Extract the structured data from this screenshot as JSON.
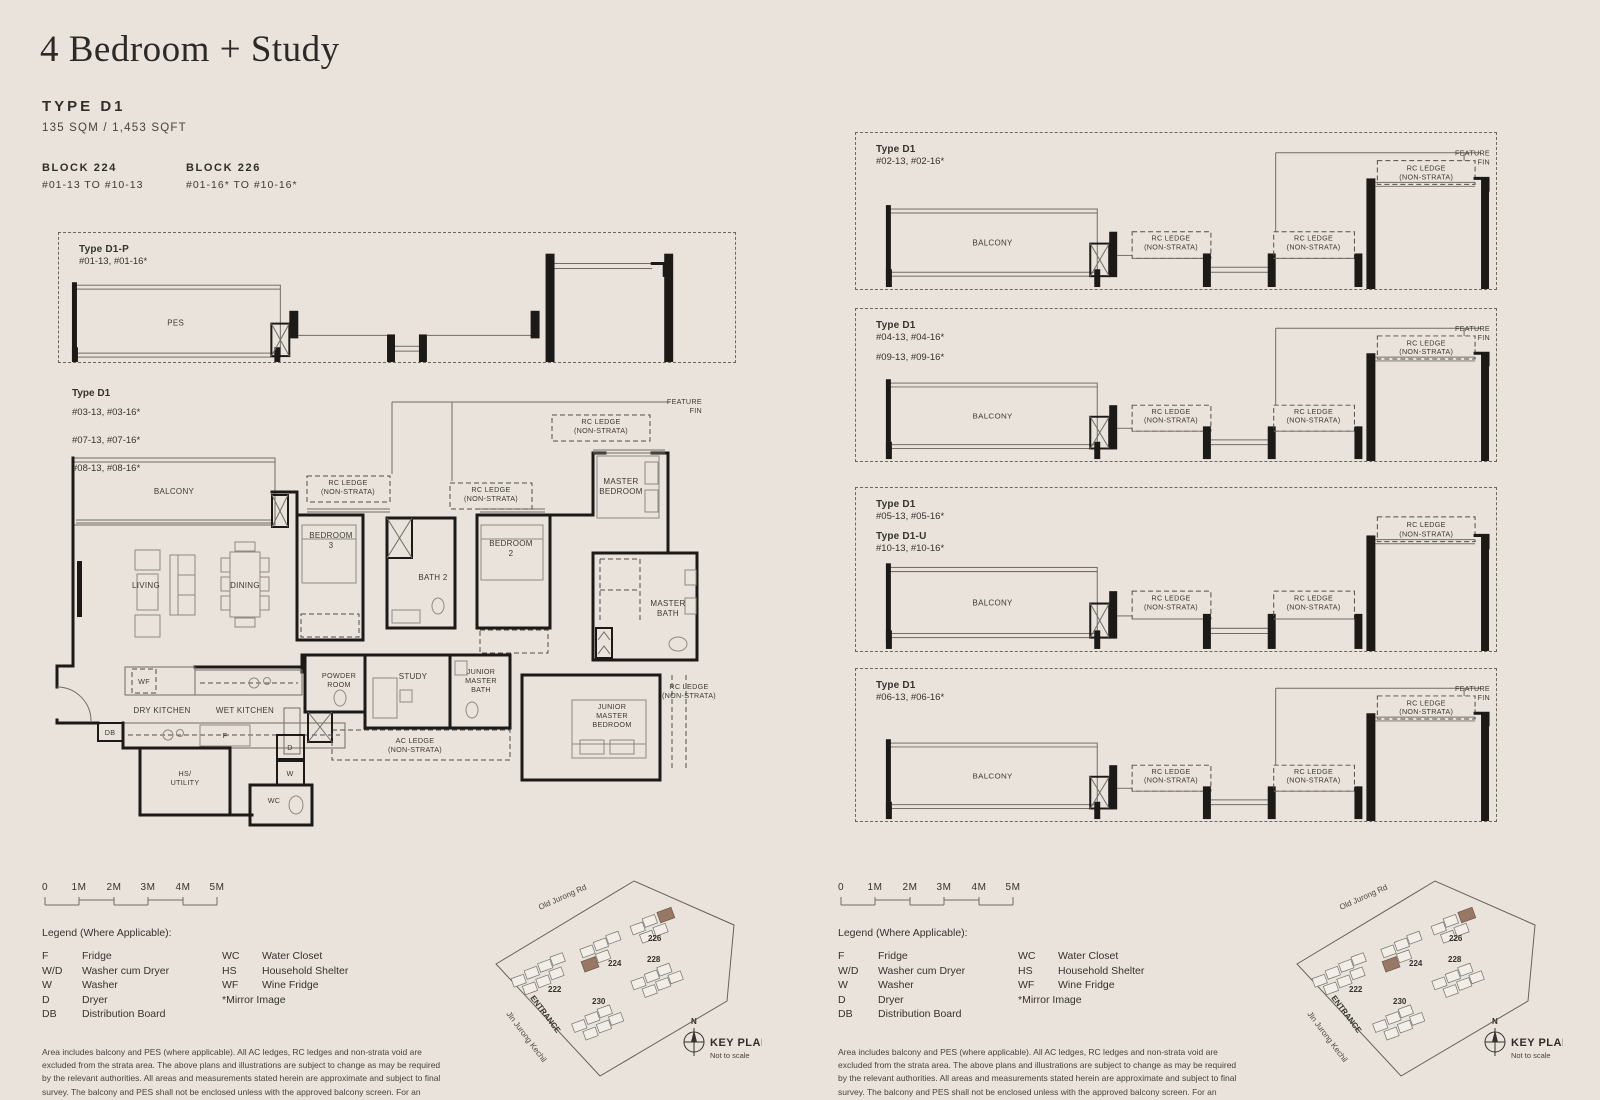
{
  "header": {
    "title": "4 Bedroom + Study",
    "type_label": "TYPE D1",
    "area": "135 SQM / 1,453 SQFT",
    "blocks": [
      {
        "name": "BLOCK 224",
        "units": "#01-13 TO #10-13"
      },
      {
        "name": "BLOCK 226",
        "units": "#01-16* TO #10-16*"
      }
    ]
  },
  "d1p": {
    "type": "Type D1-P",
    "units": "#01-13, #01-16*",
    "pes": "PES"
  },
  "main_plan": {
    "type": "Type D1",
    "units": [
      "#03-13, #03-16*",
      "#07-13, #07-16*",
      "#08-13, #08-16*"
    ],
    "rooms": {
      "balcony": "BALCONY",
      "living": "LIVING",
      "dining": "DINING",
      "bedroom3": [
        "BEDROOM",
        "3"
      ],
      "bath2": "BATH 2",
      "bedroom2": [
        "BEDROOM",
        "2"
      ],
      "master_bedroom": [
        "MASTER",
        "BEDROOM"
      ],
      "master_bath": [
        "MASTER",
        "BATH"
      ],
      "dry_kitchen": "DRY KITCHEN",
      "wet_kitchen": "WET KITCHEN",
      "powder_room": [
        "POWDER",
        "ROOM"
      ],
      "study": "STUDY",
      "junior_master_bath": [
        "JUNIOR",
        "MASTER",
        "BATH"
      ],
      "junior_master_bedroom": [
        "JUNIOR",
        "MASTER",
        "BEDROOM"
      ],
      "hs_utility": [
        "HS/",
        "UTILITY"
      ],
      "wc": "WC",
      "wf": "WF",
      "db": "DB",
      "f": "F",
      "d": "D",
      "w": "W"
    },
    "annotations": {
      "rc_ledge": [
        "RC LEDGE",
        "(NON-STRATA)"
      ],
      "ac_ledge": [
        "AC LEDGE",
        "(NON-STRATA)"
      ],
      "feature_fin": [
        "FEATURE",
        "FIN"
      ]
    }
  },
  "variants": [
    {
      "rows": [
        {
          "type": "Type D1",
          "units": "#02-13, #02-16*"
        }
      ]
    },
    {
      "rows": [
        {
          "type": "Type D1",
          "units": "#04-13, #04-16*"
        },
        {
          "units": "#09-13, #09-16*"
        }
      ]
    },
    {
      "rows": [
        {
          "type": "Type D1",
          "units": "#05-13, #05-16*"
        },
        {
          "type": "Type D1-U",
          "units": "#10-13, #10-16*"
        }
      ]
    },
    {
      "rows": [
        {
          "type": "Type D1",
          "units": "#06-13, #06-16*"
        }
      ]
    }
  ],
  "strip": {
    "balcony": "BALCONY",
    "rc_ledge": [
      "RC LEDGE",
      "(NON-STRATA)"
    ],
    "feature_fin": [
      "FEATURE",
      "FIN"
    ]
  },
  "scale_bar": {
    "labels": [
      "0",
      "1M",
      "2M",
      "3M",
      "4M",
      "5M"
    ]
  },
  "legend": {
    "title": "Legend (Where Applicable):",
    "col1": [
      [
        "F",
        "Fridge"
      ],
      [
        "W/D",
        "Washer cum Dryer"
      ],
      [
        "W",
        "Washer"
      ],
      [
        "D",
        "Dryer"
      ],
      [
        "DB",
        "Distribution Board"
      ]
    ],
    "col2": [
      [
        "WC",
        "Water Closet"
      ],
      [
        "HS",
        "Household Shelter"
      ],
      [
        "WF",
        "Wine Fridge"
      ]
    ],
    "mirror_note": "*Mirror Image",
    "disclaimer": "Area includes balcony and PES (where applicable). All AC ledges, RC ledges and non-strata void are excluded from the strata area. The above plans and illustrations are subject to change as may be required by the relevant authorities. All areas and measurements stated herein are approximate and subject to final survey. The balcony and PES shall not be enclosed unless with the approved balcony screen. For an illustration of the approved balcony screen, please refer to the diagram annexed here to and marked \"Annexure 1\"."
  },
  "keyplan": {
    "road_top": "Old Jurong Rd",
    "road_left": "Jln Jurong Kechil",
    "entrance": "ENTRANCE",
    "blocks": [
      "222",
      "224",
      "226",
      "228",
      "230"
    ],
    "north": "N",
    "title": "KEY PLAN",
    "subtitle": "Not to scale",
    "highlight_color": "#997765"
  }
}
